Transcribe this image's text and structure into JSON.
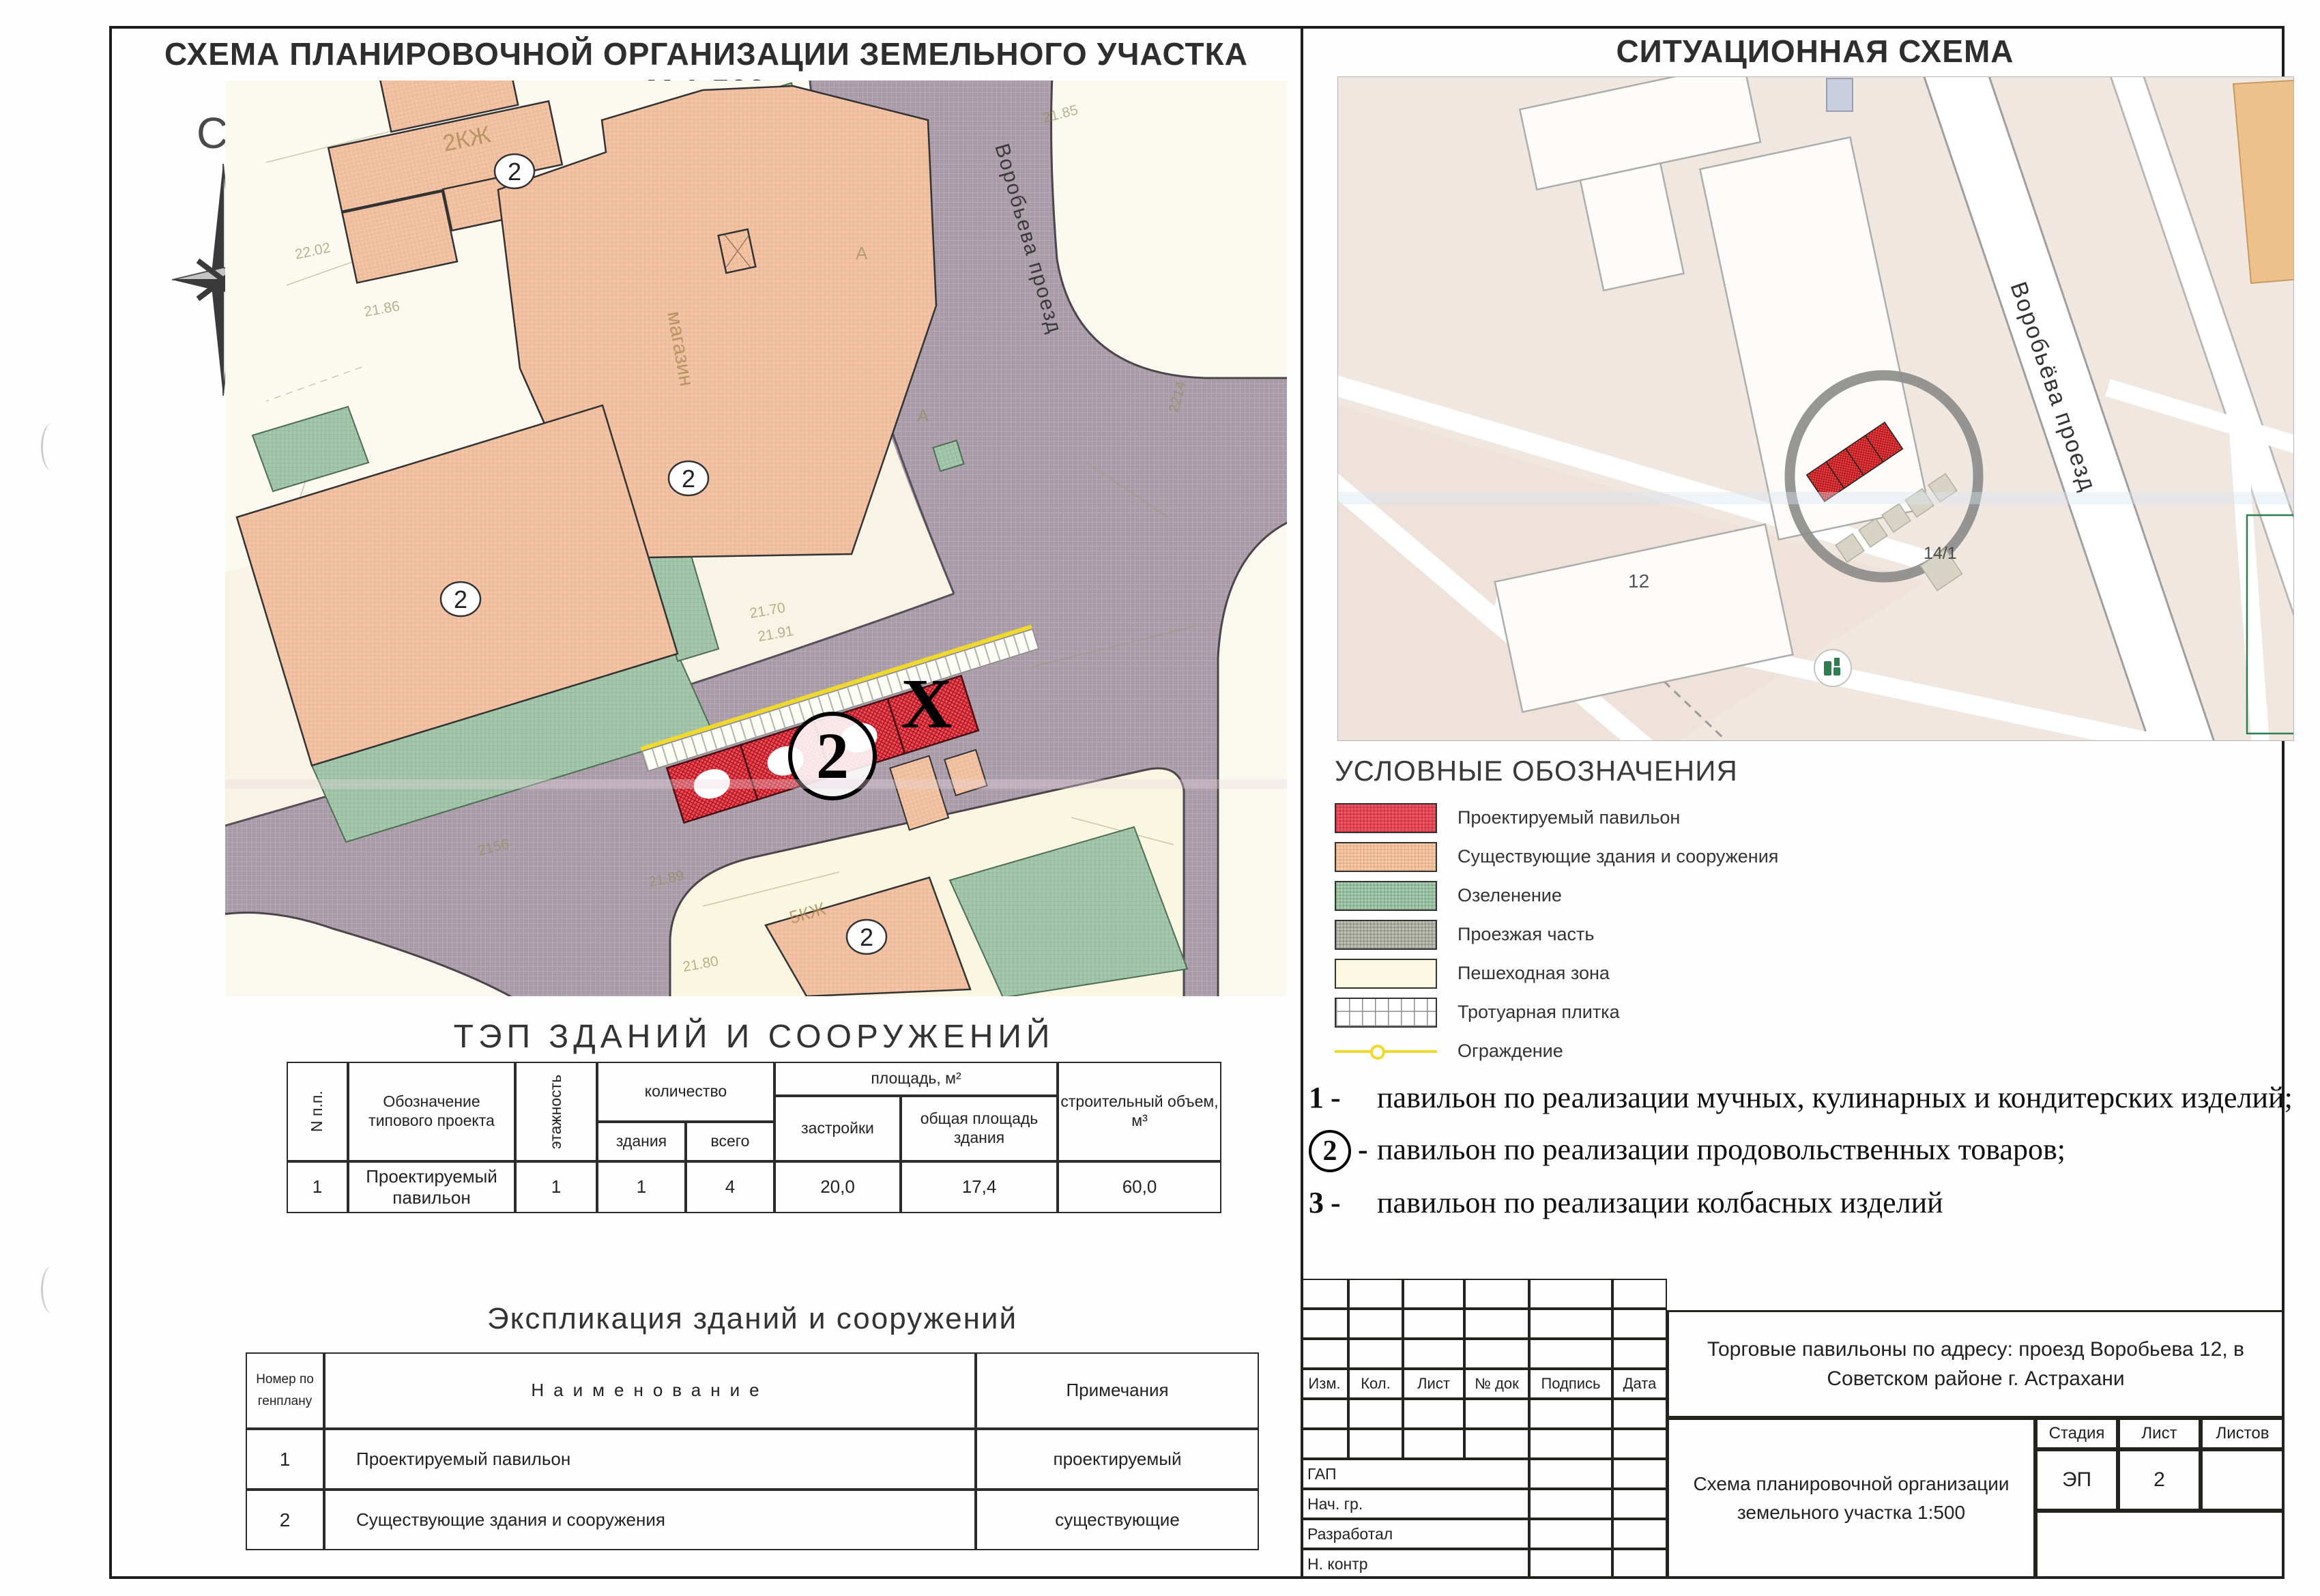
{
  "colors": {
    "pavilion_red": "#ef4b55",
    "existing_salmon": "#f3c5a7",
    "greenery": "#a6c9ae",
    "roadway_gray": "#a89aa6",
    "pedestrian_cream": "#faf7e4",
    "fence_yellow": "#f0d92c",
    "frame": "#1d1d1b"
  },
  "left": {
    "title": "СХЕМА ПЛАНИРОВОЧНОЙ ОРГАНИЗАЦИИ ЗЕМЕЛЬНОГО УЧАСТКА М  1:500",
    "compass": "С",
    "map": {
      "street_label": "Воробьева проезд",
      "badge": "2",
      "x_mark": "Х",
      "annotations": [
        "2КЖ",
        "магазин",
        "5КЖ",
        "21.85",
        "21.70",
        "21.91",
        "22.02",
        "21.86",
        "2156",
        "2214",
        "21.80",
        "21.89",
        "А",
        "А"
      ]
    },
    "tep": {
      "title": "ТЭП ЗДАНИЙ И СООРУЖЕНИЙ",
      "headers": {
        "num": "N п.п.",
        "designation": "Обозначение типового проекта",
        "floors": "этажность",
        "quantity": "количество",
        "qty_buildings": "здания",
        "qty_total": "всего",
        "area": "площадь, м²",
        "area_built": "застройки",
        "area_total": "общая площадь здания",
        "volume": "строительный объем, м³"
      },
      "row": {
        "num": "1",
        "designation": "Проектируемый павильон",
        "floors": "1",
        "qty_buildings": "1",
        "qty_total": "4",
        "area_built": "20,0",
        "area_total": "17,4",
        "volume": "60,0"
      }
    },
    "expl": {
      "title": "Экспликация зданий и сооружений",
      "headers": {
        "num": "Номер по генплану",
        "name": "Наименование",
        "notes": "Примечания"
      },
      "rows": [
        {
          "num": "1",
          "name": "Проектируемый павильон",
          "notes": "проектируемый"
        },
        {
          "num": "2",
          "name": "Существующие здания и сооружения",
          "notes": "существующие"
        }
      ]
    }
  },
  "right": {
    "title": "СИТУАЦИОННАЯ СХЕМА",
    "map": {
      "street_label": "Воробьёва проезд",
      "label_12": "12",
      "label_14": "14/1"
    },
    "legend": {
      "title": "УСЛОВНЫЕ ОБОЗНАЧЕНИЯ",
      "items": [
        {
          "name": "proposed-pavilion",
          "label": "Проектируемый павильон",
          "color": "#ef4b55"
        },
        {
          "name": "existing-buildings",
          "label": "Существующие здания и сооружения",
          "color": "#f3c5a7"
        },
        {
          "name": "greenery",
          "label": "Озеленение",
          "color": "#a6c9ae"
        },
        {
          "name": "roadway",
          "label": "Проезжая часть",
          "color": "#bcbfb4"
        },
        {
          "name": "pedestrian-zone",
          "label": "Пешеходная зона",
          "color": "#fbf8e2"
        },
        {
          "name": "paving-tile",
          "label": "Тротуарная плитка",
          "color": "#ffffff"
        },
        {
          "name": "fence",
          "label": "Ограждение",
          "color": "#f0d92c"
        }
      ]
    },
    "notes": [
      {
        "num": "1",
        "text": "павильон по реализации мучных, кулинарных и кондитерских изделий;",
        "circled": false
      },
      {
        "num": "2",
        "text": "павильон по реализации продовольственных товаров;",
        "circled": true
      },
      {
        "num": "3",
        "text": "павильон по реализации колбасных изделий",
        "circled": false
      }
    ],
    "stamp": {
      "rev_headers": [
        "Изм.",
        "Кол.",
        "Лист",
        "№ док",
        "Подпись",
        "Дата"
      ],
      "roles": [
        "ГАП",
        "Нач. гр.",
        "Разработал",
        "Н. контр"
      ],
      "project": "Торговые павильоны по адресу: проезд Воробьева 12, в Советском районе г. Астрахани",
      "doc_name": "Схема планировочной организации земельного участка  1:500",
      "stage_label": "Стадия",
      "sheet_label": "Лист",
      "sheets_label": "Листов",
      "stage": "ЭП",
      "sheet_num": "2",
      "sheets_total": ""
    }
  }
}
